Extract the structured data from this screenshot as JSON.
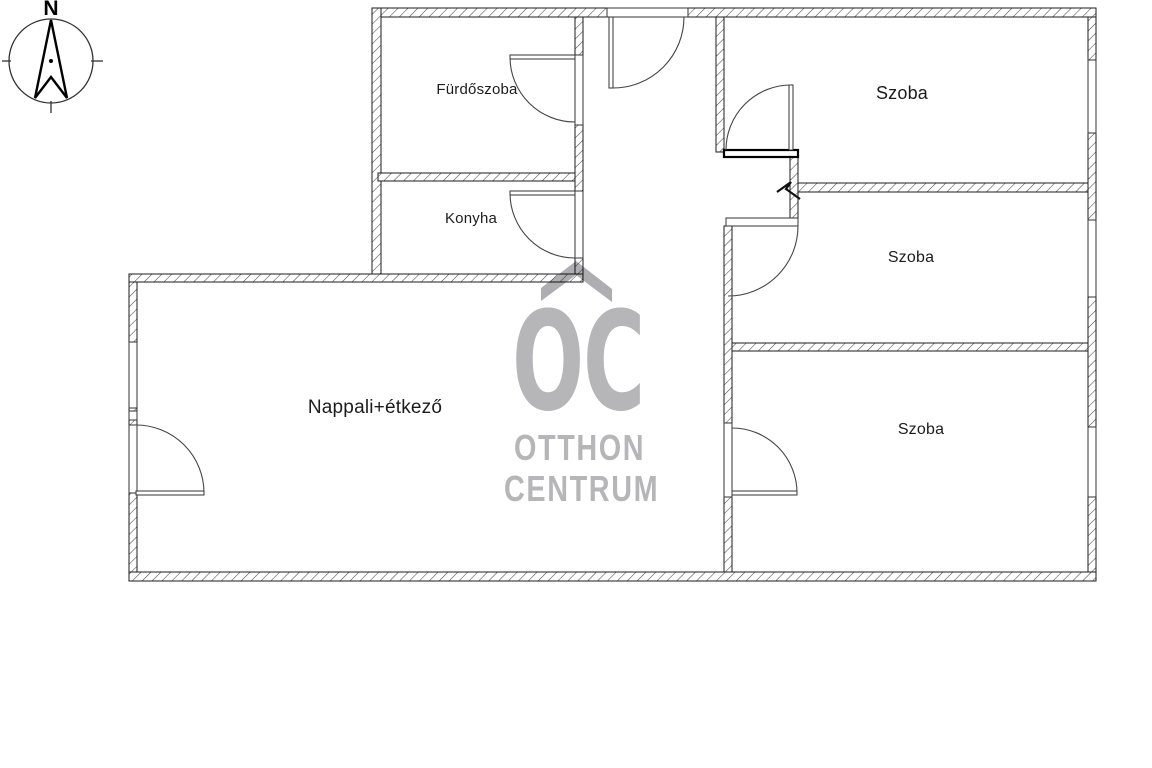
{
  "plan": {
    "rooms": {
      "bathroom": {
        "label": "Fürdőszoba"
      },
      "kitchen": {
        "label": "Konyha"
      },
      "living": {
        "label": "Nappali+étkező"
      },
      "bedroom_top": {
        "label": "Szoba"
      },
      "bedroom_middle": {
        "label": "Szoba"
      },
      "bedroom_bottom": {
        "label": "Szoba"
      }
    }
  },
  "compass": {
    "north_label": "N"
  },
  "watermark": {
    "monogram": "OC",
    "line1": "OTTHON",
    "line2": "CENTRUM",
    "color": "#b6b6b9"
  },
  "colors": {
    "background": "#ffffff",
    "line": "#1b1b1b",
    "hatch": "#4a4a4a",
    "label_text": "#1c1c1c"
  }
}
